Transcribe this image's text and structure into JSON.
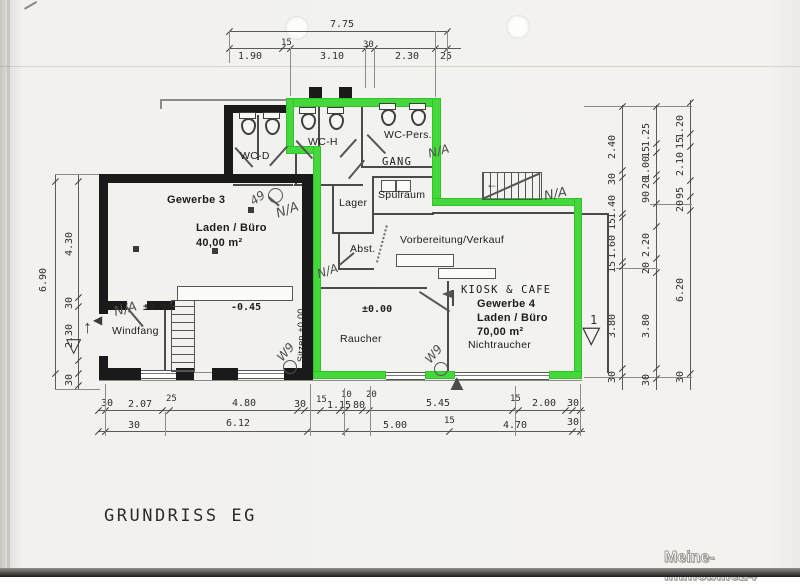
{
  "document": {
    "title": "GRUNDRISS EG",
    "watermark": "Meine-Immobilie24"
  },
  "colors": {
    "highlight_green": "#43d93a",
    "wall_black": "#1a1a1a",
    "paper": "#f2f1ed"
  },
  "rooms": {
    "gewerbe3": {
      "title": "Gewerbe 3",
      "use": "Laden / Büro",
      "area": "40,00 m²",
      "level": "-0.45"
    },
    "gewerbe4": {
      "header": "KIOSK & CAFE",
      "title": "Gewerbe 4",
      "use": "Laden / Büro",
      "area": "70,00 m²",
      "note": "Nichtraucher"
    },
    "wc_d": "WC-D",
    "wc_h": "WC-H",
    "wc_pers": "WC-Pers.",
    "gang": "GANG",
    "lager": "Lager",
    "spuelraum": "Spülraum",
    "abst": "Abst.",
    "vorbereitung": "Vorbereitung/Verkauf",
    "raucher": "Raucher",
    "windfang": "Windfang",
    "sitzen_note": "Sitzen ±0.00",
    "level_zero_windfang": "±0.00",
    "level_zero_raucher": "±0.00"
  },
  "annotations": {
    "entrance_number": "1",
    "na": "N/A",
    "mark_49": "49",
    "mark_w9": "W9"
  },
  "icons": {
    "triangle_down": "▽",
    "triangle_up": "▲",
    "arrow_up": "↑",
    "arrow_left": "←",
    "triangle_left": "◀"
  },
  "dimensions": {
    "top_outer": "7.75",
    "top_inner": [
      "1.90",
      "15",
      "3.10",
      "30",
      "2.30",
      "25"
    ],
    "bottom_upper": [
      "30",
      "2.07",
      "25",
      "4.80",
      "30",
      "15",
      "1.15",
      "10",
      "80",
      "20",
      "5.45",
      "15",
      "2.00",
      "30"
    ],
    "bottom_lower": [
      "30",
      "6.12",
      "5.00",
      "15",
      "4.70",
      "30"
    ],
    "left_outer": "6.90",
    "left_inner": [
      "4.30",
      "30",
      "2.30",
      "30"
    ],
    "right_inner": [
      "2.40",
      "30",
      "1.40",
      "15",
      "1.60",
      "15",
      "3.80",
      "30"
    ],
    "right_middle": [
      "1.25",
      "15",
      "1.00",
      "20",
      "90",
      "2.20",
      "20",
      "3.80",
      "30"
    ],
    "right_outer": [
      "1.20",
      "15",
      "2.10",
      "95",
      "20",
      "6.20",
      "30"
    ]
  }
}
